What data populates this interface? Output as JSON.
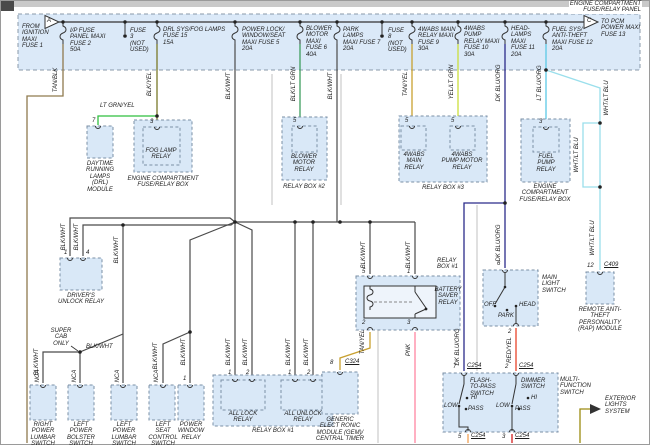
{
  "diagram": {
    "title": "ENGINE COMPARTMENT FUSE/RELAY PANEL",
    "type": "automotive wiring diagram"
  },
  "colors": {
    "panel_fill": "#dbe9f8",
    "box_fill": "#d9e8f7",
    "wire_tan_blk": "#8f7a4e",
    "wire_blk_yel": "#7a7a28",
    "wire_lt_grn_yel": "#2fbf3f",
    "wire_blk_lt_grn": "#3f9f5f",
    "wire_blk_wht": "#4a4a4a",
    "wire_tan_yel": "#c8a030",
    "wire_yel_lt_grn": "#cbdf3c",
    "wire_dk_blu_org": "#2b2b8a",
    "wire_lt_blu_org": "#5cc8e6",
    "wire_wht_lt_blu": "#9adfec",
    "wire_pnk": "#ff85a2",
    "wire_red_yel": "#e8432a",
    "wire_org": "#f0a055",
    "wire_red": "#d42020",
    "wire_dk_yel": "#9c8b10"
  },
  "L": [
    "ENGINE COMPARTMENT\nFUSE/RELAY PANEL",
    "FROM\nIGNITION\nMAXI\nFUSE 1",
    "A",
    "I/P FUSE\nPANEL MAXI\nFUSE 2\n50A",
    "FUSE\n3\n(NOT\nUSED)",
    "DRL SYS/FOG LAMPS\nFUSE 15\n15A",
    "POWER LOCK/\nWINDOW/SEAT\nMAXI FUSE 5\n20A",
    "BLOWER\nMOTOR\nMAXI\nFUSE 6\n40A",
    "PARK\nLAMPS\nMAXI FUSE 7\n20A",
    "FUSE\n8\n(NOT\nUSED)",
    "4WABS MAIN\nRELAY MAXI\nFUSE 9\n30A",
    "4WABS\nPUMP\nRELAY MAXI\nFUSE 10\n30A",
    "HEAD-\nLAMPS\nMAXI\nFUSE 11\n20A",
    "FUEL SYS/\nANTI-THEFT\nMAXI FUSE 12\n20A",
    "C",
    "TO PCM\nPOWER MAXI\nFUSE 13",
    "TAN/BLK",
    "BLK/YEL",
    "BLK/WHT",
    "BLK/LT GRN",
    "BLK/WHT",
    "TAN/YEL",
    "YEL/LT GRN",
    "DK BLU/ORG",
    "LT BLU/ORG",
    "WHT/LT BLU",
    "LT GRN/YEL",
    "7",
    "DAYTIME\nRUNNING\nLAMPS\n(DRL)\nMODULE",
    "3",
    "FOG LAMP\nRELAY",
    "ENGINE COMPARTMENT\nFUSE/RELAY BOX",
    "5",
    "BLOWER\nMOTOR\nRELAY",
    "RELAY BOX #2",
    "5",
    "5",
    "4WABS\nMAIN\nRELAY",
    "4WABS\nPUMP MOTOR\nRELAY",
    "RELAY BOX #3",
    "3",
    "FUEL\nPUMP\nRELAY",
    "ENGINE\nCOMPARTMENT\nFUSE/RELAY BOX",
    "WHT/LT BLU",
    "WHT/LT BLU",
    "12",
    "C409",
    "REMOTE ANTI-\nTHEFT\nPERSONALITY\n(RAP) MODULE",
    "BLK/WHT",
    "BLK/WHT",
    "1",
    "4",
    "DRIVER'S\nUNLOCK RELAY",
    "BLK/WHT",
    "SUPER\nCAB\nONLY",
    "BLK/WHT",
    "BLK/WHT",
    "NCA",
    "NCA",
    "NCA",
    "NCA",
    "1",
    "RIGHT\nPOWER\nLUMBAR\nSWITCH",
    "LEFT\nPOWER\nBOLSTER\nSWITCH",
    "LEFT\nPOWER\nLUMBAR\nSWITCH",
    "LEFT\nSEAT\nCONTROL\nSWITCH",
    "POWER\nWINDOW\nRELAY",
    "BLK/WHT",
    "BLK/WHT",
    "BLK/WHT",
    "BLK/WHT",
    "BLK/WHT",
    "BLK/WHT",
    "1",
    "2",
    "1",
    "2",
    "ALL LOCK\nRELAY",
    "ALL UNLOCK\nRELAY",
    "RELAY BOX #1",
    "RELAY\nBOX #1",
    "BLK/WHT",
    "BLK/WHT",
    "5",
    "1",
    "2",
    "3",
    "BATTERY\nSAVER\nRELAY",
    "TAN/YEL",
    "PNK",
    "8",
    "C324",
    "GENERIC\nELECT RONIC\nMODULE (GEM)/\nCENTRAL TIMER",
    "DK BLU/ORG",
    "6",
    "OFF",
    "PARK",
    "HEAD",
    "MAIN\nLIGHT\nSWITCH",
    "2",
    "RED/YEL",
    "DK BLU/ORG",
    "7",
    "C254",
    "2",
    "C254",
    "FLASH-\nTO-PASS\nSWITCH",
    "DIMMER\nSWITCH",
    "LOW",
    "HI",
    "PASS",
    "LOW",
    "PASS",
    "HI",
    "5",
    "C254",
    "3",
    "C254",
    "MULTI-\nFUNCTION\nSWITCH",
    "EXTERIOR\nLIGHTS\nSYSTEM"
  ]
}
